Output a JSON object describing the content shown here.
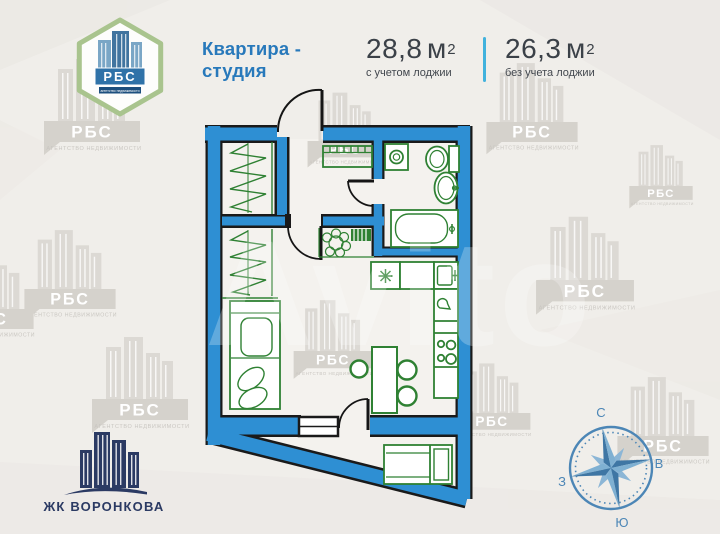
{
  "brand_logo": {
    "name": "РБС",
    "tagline": "агентство недвижимости"
  },
  "header": {
    "title_line1": "Квартира -",
    "title_line2": "студия"
  },
  "areas": {
    "with_loggia": {
      "value": "28,8",
      "unit": "м",
      "sup": "2",
      "caption": "с учетом лоджии"
    },
    "without_loggia": {
      "value": "26,3",
      "unit": "м",
      "sup": "2",
      "caption": "без учета лоджии"
    }
  },
  "compass": {
    "north": "С",
    "east": "В",
    "south": "Ю",
    "west": "З"
  },
  "complex_logo": {
    "name": "ЖК ВОРОНКОВА"
  },
  "watermarks": {
    "brand": "РБС",
    "agency": "АГЕНТСТВО НЕДВИЖИМОСТИ",
    "marketplace": "Avito"
  },
  "colors": {
    "wall_blue": "#2E8FD3",
    "furniture_green": "#2F8133",
    "title_blue": "#2879BB",
    "text_dark": "#3B4148",
    "divider_blue": "#41B2DD",
    "compass_blue": "#4C86B6",
    "complex_navy": "#2B3A63",
    "watermark_grey": "#D9D6D1",
    "background": "#F0EEEA"
  }
}
